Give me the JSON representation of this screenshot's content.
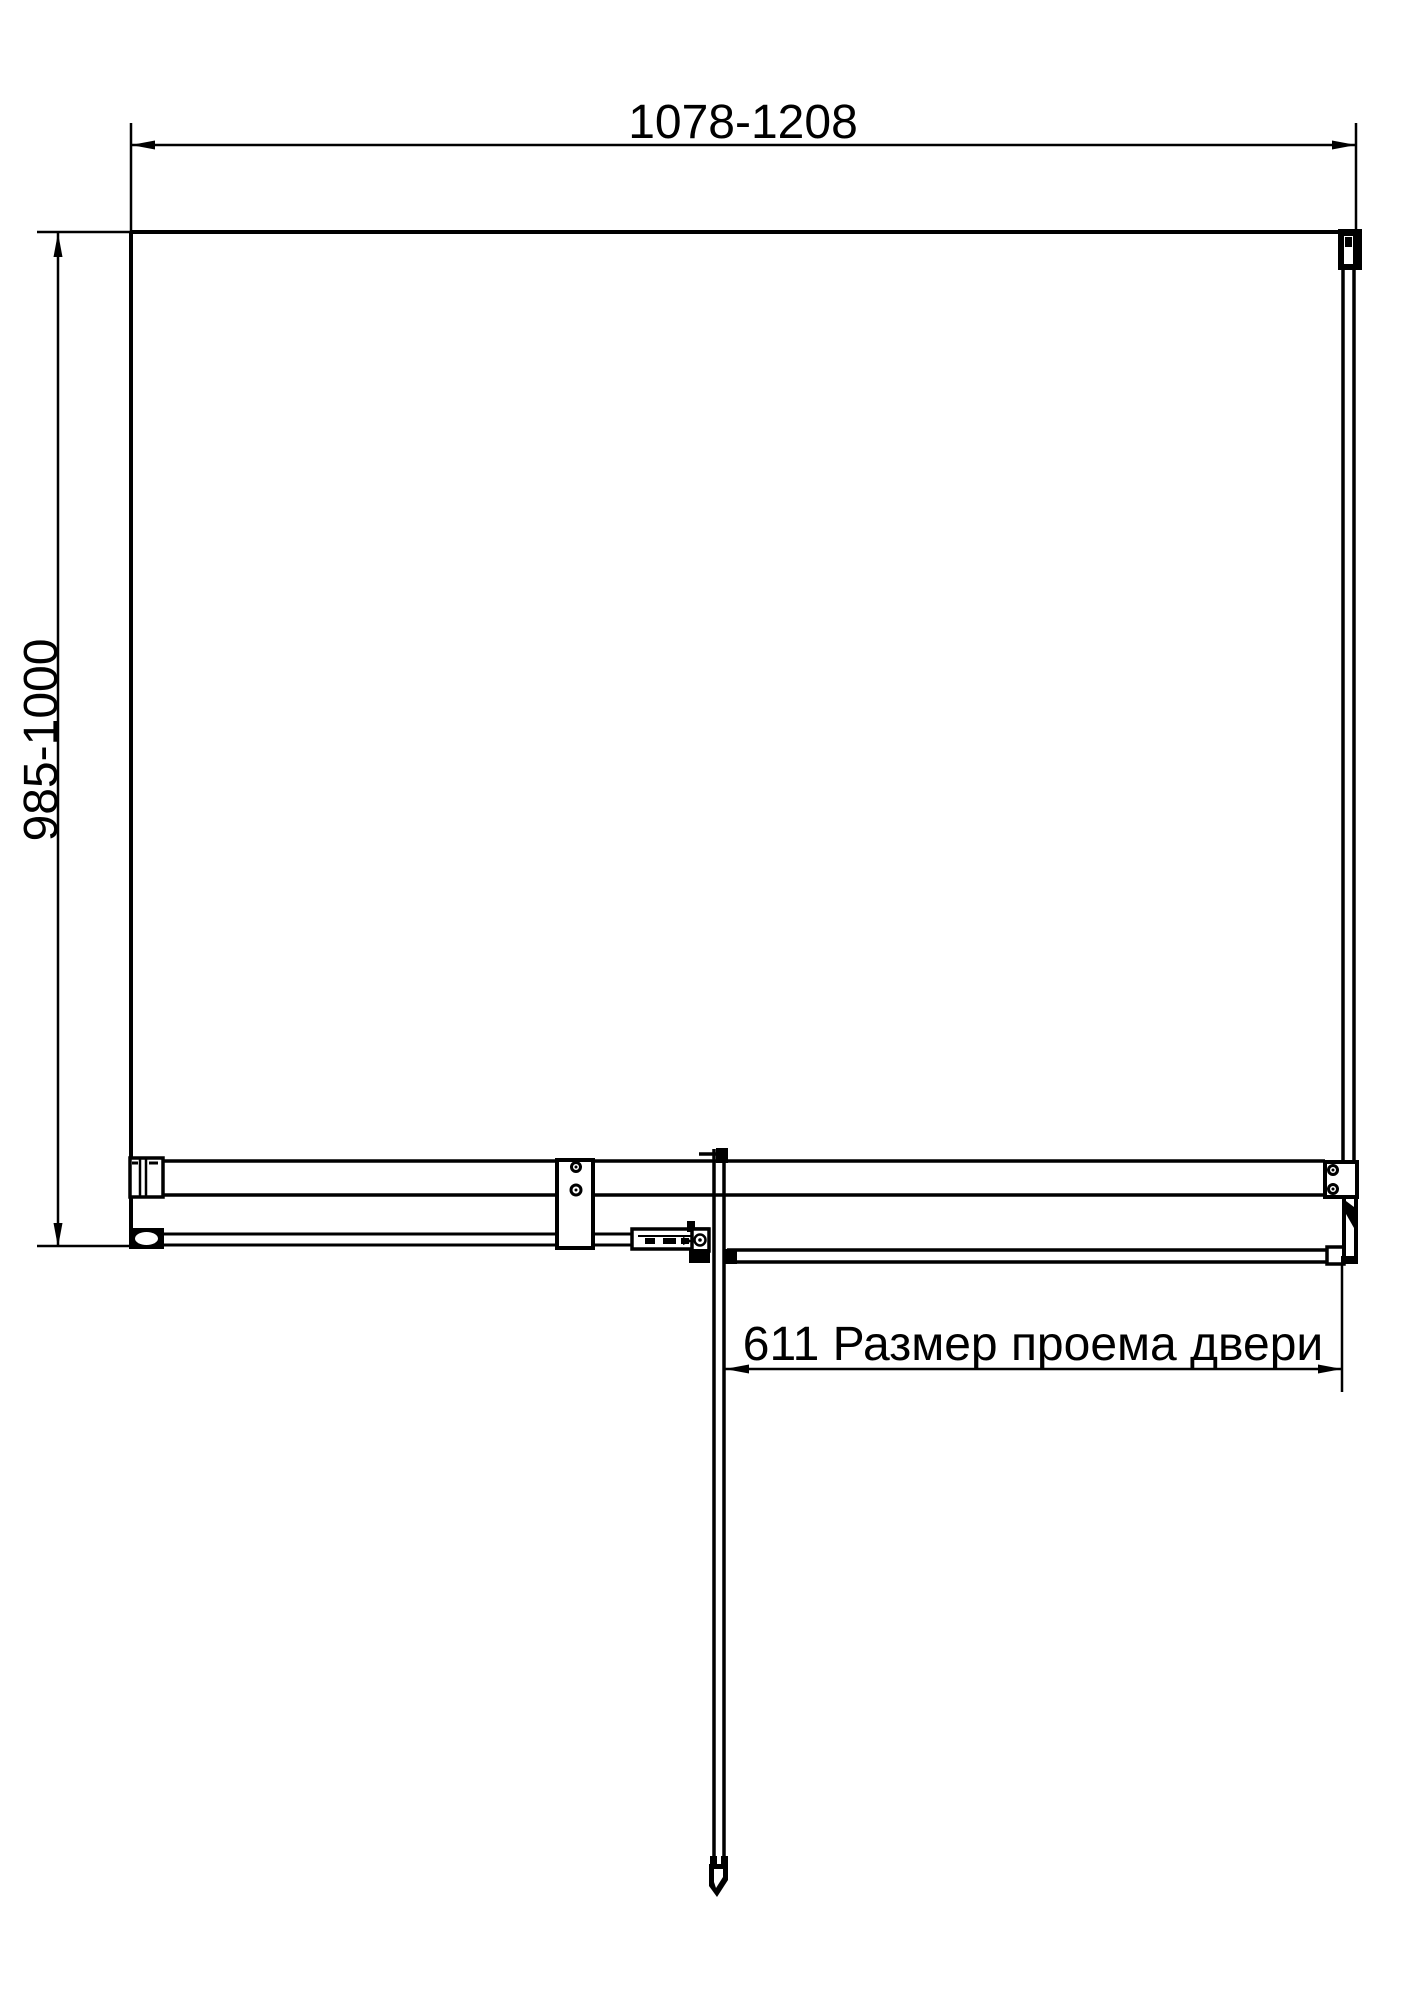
{
  "drawing": {
    "type": "technical-plan-view-shower-enclosure",
    "colors": {
      "background": "#ffffff",
      "line": "#000000"
    },
    "dim_width": {
      "label": "1078-1208"
    },
    "dim_height": {
      "label": "985-1000"
    },
    "dim_door_opening": {
      "label": "611 Размер проема двери"
    }
  }
}
